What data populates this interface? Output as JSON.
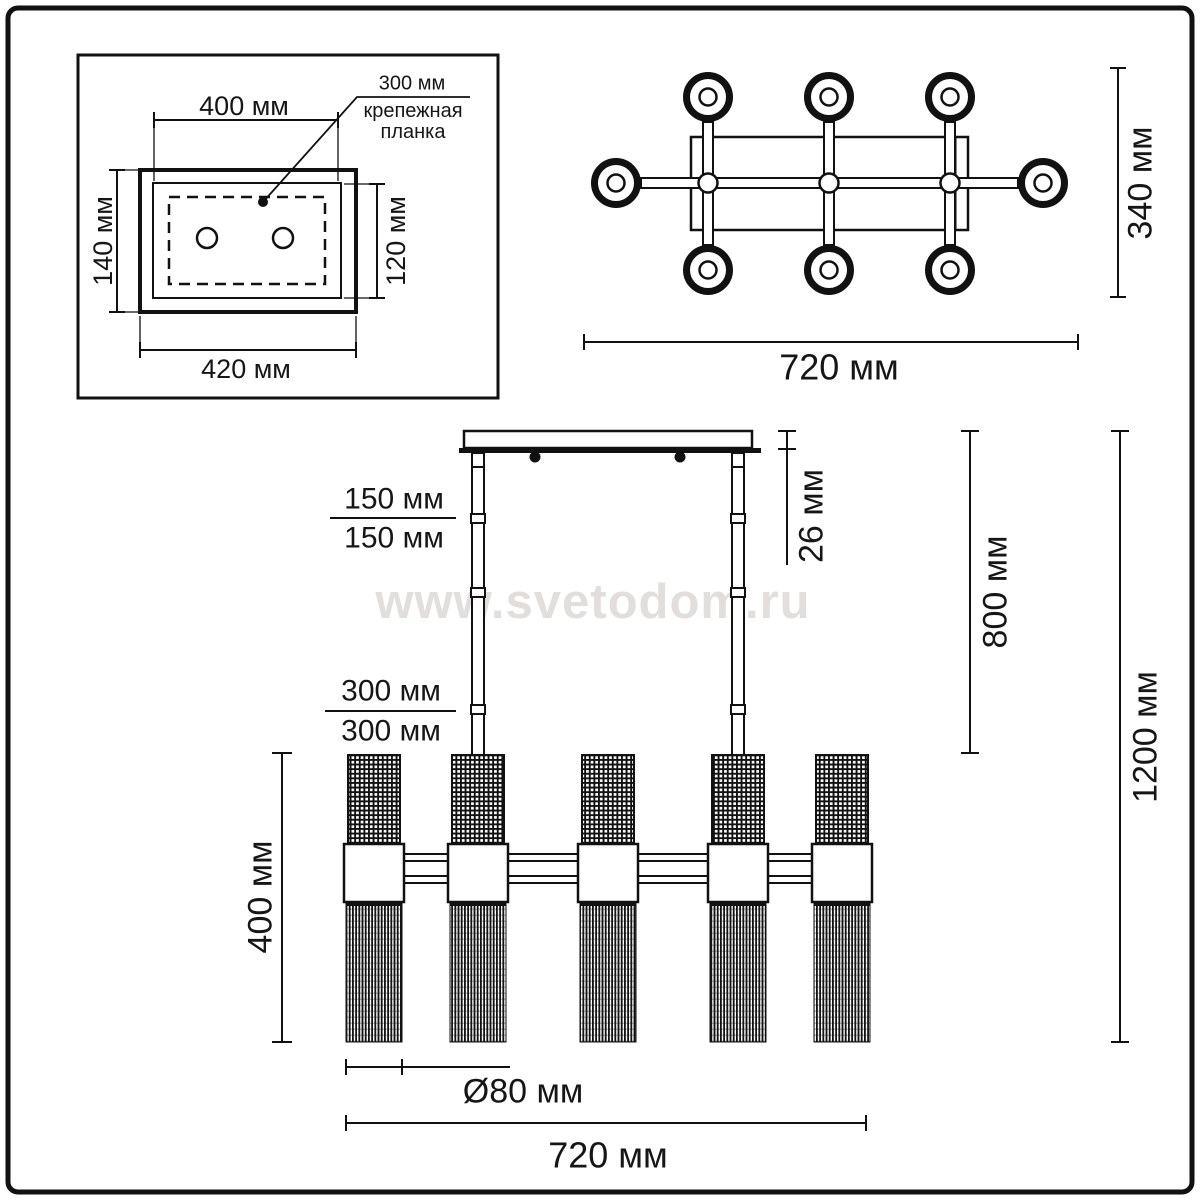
{
  "watermark": "www.svetodom.ru",
  "colors": {
    "line": "#111111",
    "watermark": "#e2dedb"
  },
  "mount_inset": {
    "width_top": "400 мм",
    "width_bottom": "420 мм",
    "height_left": "140 мм",
    "height_right": "120 мм",
    "callout_value": "300 мм",
    "callout_label": "крепежная\nпланка"
  },
  "top_view": {
    "width": "720 мм",
    "depth": "340 мм"
  },
  "side_view": {
    "rod_segment_upper_a": "150 мм",
    "rod_segment_upper_b": "150 мм",
    "rod_segment_lower_a": "300 мм",
    "rod_segment_lower_b": "300 мм",
    "canopy_height": "26 мм",
    "rod_length": "800 мм",
    "total_height": "1200 мм",
    "shade_height": "400 мм",
    "shade_diameter": "Ø80 мм",
    "width": "720 мм"
  }
}
